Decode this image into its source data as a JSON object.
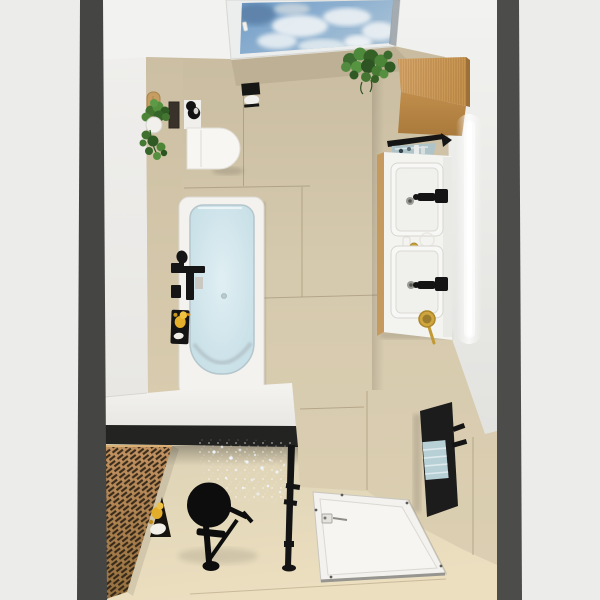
{
  "scene": {
    "kind": "3d-interior-render",
    "view": "top-down bathroom",
    "labels": {
      "viewport": "Bathroom top-down 3D render",
      "ceiling": "White ceiling",
      "skylight": "Ceiling skylight with sky and clouds",
      "hanging_plant": "Hanging green plant",
      "wall_plant": "Trailing plant in white pot",
      "wood_board": "Wooden board on wall",
      "wall_niche": "Dark wall niche",
      "toilet": "Wall-hung toilet",
      "toilet_brush": "Black toilet brush",
      "toilet_paper_holder": "Black toilet paper holder with roll",
      "bathtub": "Bathtub with pale blue basin",
      "bath_faucet": "Black wall-mounted bath mixer",
      "bath_duck": "Rubber duck on black tub shelf",
      "cabinet": "Tall oak cabinet",
      "towel_bar": "Black towel bar",
      "glass_shelf": "Glass shelf with toiletries",
      "led_strip": "Vertical LED light strip",
      "vanity": "Double washbasin vanity",
      "sink_1": "Upper washbasin with black tap",
      "sink_2": "Lower washbasin with black tap",
      "hand_mirror": "Gold hand mirror",
      "radiator": "Black towel radiator",
      "towels": "Light blue towels",
      "bench": "White bench top with black frame",
      "slat_panel": "Diagonal wood slat panel",
      "floor_duck": "Rubber duck with towel on floor",
      "shower_stool": "Black round shower stool",
      "water_spray": "Sparkling water spray",
      "glass_frame": "Shower glass frame post",
      "shower_tray": "Walk-in shower tray with drain",
      "left_wall": "Left wall",
      "right_wall": "Right wall",
      "floor": "Beige tiled floor",
      "left_wall_bar": "Left wall section edge",
      "right_wall_bar": "Right wall section edge"
    },
    "palette": {
      "exterior": "#ececea",
      "wall_bar": "#454543",
      "ceiling": "#f1f1ef",
      "wall_tile": "#d5c9ad",
      "floor_tile": "#e7dcbe",
      "wood": "#c6934f",
      "tub_water": "#cfe3e9",
      "fixture_black": "#151515",
      "towel_blue": "#b7d0d6",
      "plant_green": "#447632",
      "duck_yellow": "#e5b02c",
      "mirror_gold": "#cfa63e",
      "sky_blue": "#7ea6cd"
    }
  }
}
